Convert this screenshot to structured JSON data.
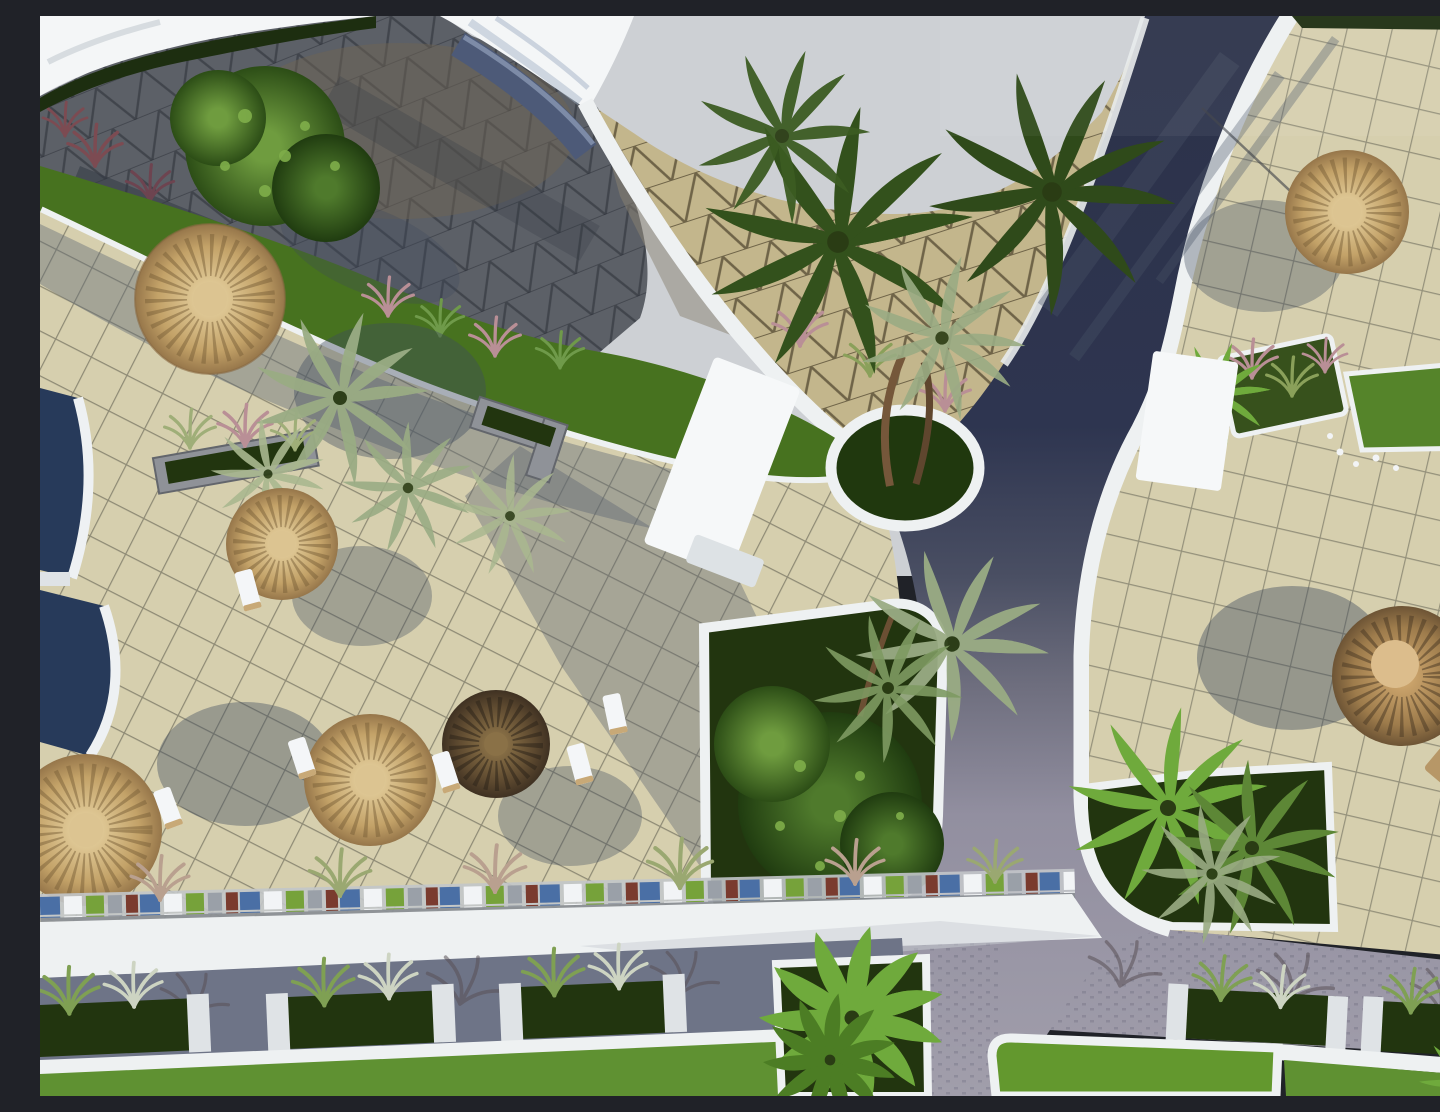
{
  "scene": {
    "title": "Aerial 3D rendering of a resort pool terrace and landscaped plaza with straw umbrellas, palm trees and paved walkways",
    "type": "architectural-visualization",
    "view": "top-down aerial",
    "objects": {
      "straw_umbrellas": 7,
      "sun_loungers": 6,
      "swimming_pool_segments": 2,
      "palm_tree_clusters": 6,
      "planter_beds": 12,
      "lawn_patches": 4,
      "pathways": 3,
      "white_kiosk_roofs": 2
    }
  },
  "palette": {
    "sky": "#cdd0d4",
    "roofWhite": "#f4f6f7",
    "curbWhite": "#eef1f2",
    "plaza": "#5c6067",
    "plazaBrown": "#6e6354",
    "plazaShadow": "#343a44",
    "triBeige": "#c3b68c",
    "triLine": "#6f6448",
    "navyPath": "#2c3249",
    "pathLight": "#9d99a6",
    "tanTile": "#d6cfae",
    "gridLine": "#45453c",
    "terraceShade": "#5f6875",
    "grass": "#47721f",
    "grassBright": "#5f9132",
    "lawnBright": "#63982e",
    "planterDark": "#22350f",
    "hedge": "#1d2e10",
    "bushLight": "#7fae4a",
    "palmDark": "#33511c",
    "palmGray": "#9aac84",
    "palmBright": "#6faa3c",
    "thatchLight": "#d9bf8a",
    "thatchMid": "#b08a4e",
    "thatchDark": "#8a6b3c",
    "thatchBrown": "#553f2a",
    "pool": "#273a5a",
    "stone": "#8f9298",
    "roadBlue": "#6e7487",
    "roadLight": "#8a8a95",
    "accentBlue": "#4a6fa5",
    "accentGreen": "#76a23a",
    "accentRust": "#7a3b2e",
    "shadow": "#3e4a5e"
  }
}
